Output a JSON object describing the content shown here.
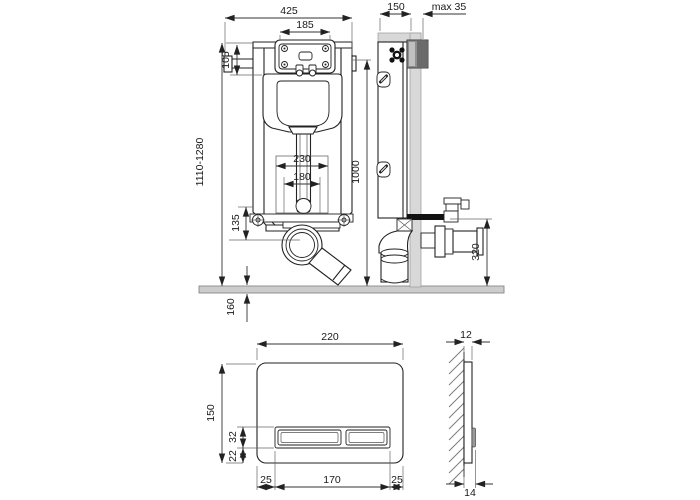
{
  "title": "concealed-cistern-installation-drawing",
  "colors": {
    "line": "#222222",
    "floor_gray": "#cccccc",
    "wall_gray": "#d8d8d8",
    "plate_block_gray": "#8f8f8f"
  },
  "dims": {
    "front": {
      "total_width": "425",
      "opening_width": "185",
      "opening_height": "105",
      "height_range": "1110-1280",
      "zone_outer": "230",
      "zone_inner": "180",
      "frame_height": "1000",
      "drain_offset": "135",
      "below_floor": "160"
    },
    "side": {
      "depth": "150",
      "protrusion": "max 35",
      "outlet_height": "320"
    },
    "plate_front": {
      "width": "220",
      "height": "150",
      "button_height": "32",
      "button_bottom_offset": "22",
      "margin_left": "25",
      "button_width": "170",
      "margin_right": "25"
    },
    "plate_side": {
      "thickness": "12",
      "total_thickness": "14"
    }
  }
}
